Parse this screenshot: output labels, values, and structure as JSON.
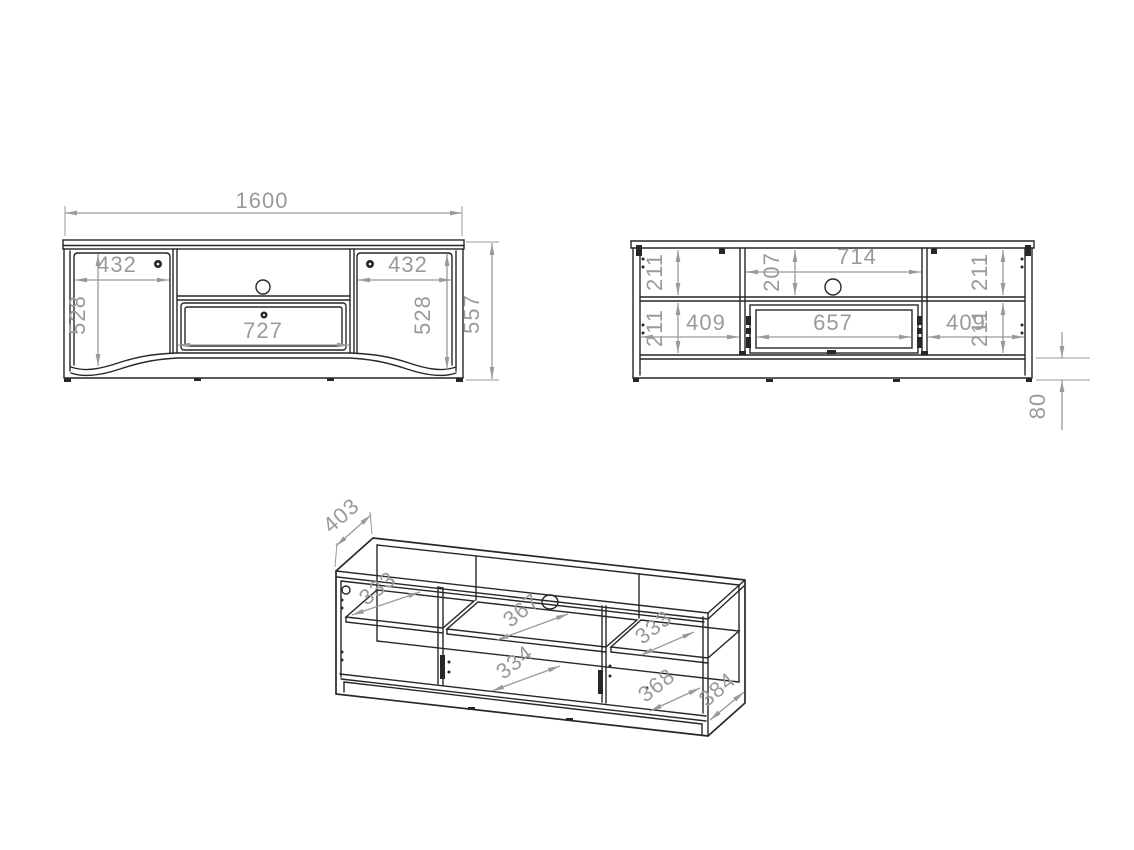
{
  "drawing": {
    "type": "furniture technical dimension drawing",
    "subject": "TV stand / lowboard with two doors, centre shelf and drawer",
    "colors": {
      "background": "#ffffff",
      "line": "#272727",
      "dimension": "#9a9a9a"
    },
    "views": {
      "front_closed": {
        "dims": {
          "overall_width": "1600",
          "overall_height": "557",
          "left_door_width": "432",
          "left_door_height": "528",
          "right_door_width": "432",
          "right_door_height": "528",
          "drawer_front_width": "727"
        }
      },
      "front_open": {
        "dims": {
          "left_top_compartment_height": "211",
          "left_bottom_compartment_height": "211",
          "left_compartment_width": "409",
          "center_top_compartment_height": "207",
          "center_opening_width": "714",
          "drawer_box_width": "657",
          "right_top_compartment_height": "211",
          "right_bottom_compartment_height": "211",
          "right_compartment_width": "409",
          "plinth_height": "80"
        }
      },
      "isometric": {
        "dims": {
          "top_panel_depth": "403",
          "left_shelf_depth": "333",
          "center_shelf_depth": "367",
          "center_bottom_depth": "334",
          "right_shelf_depth": "333",
          "right_bottom_depth": "368",
          "side_panel_depth": "384"
        }
      }
    }
  }
}
